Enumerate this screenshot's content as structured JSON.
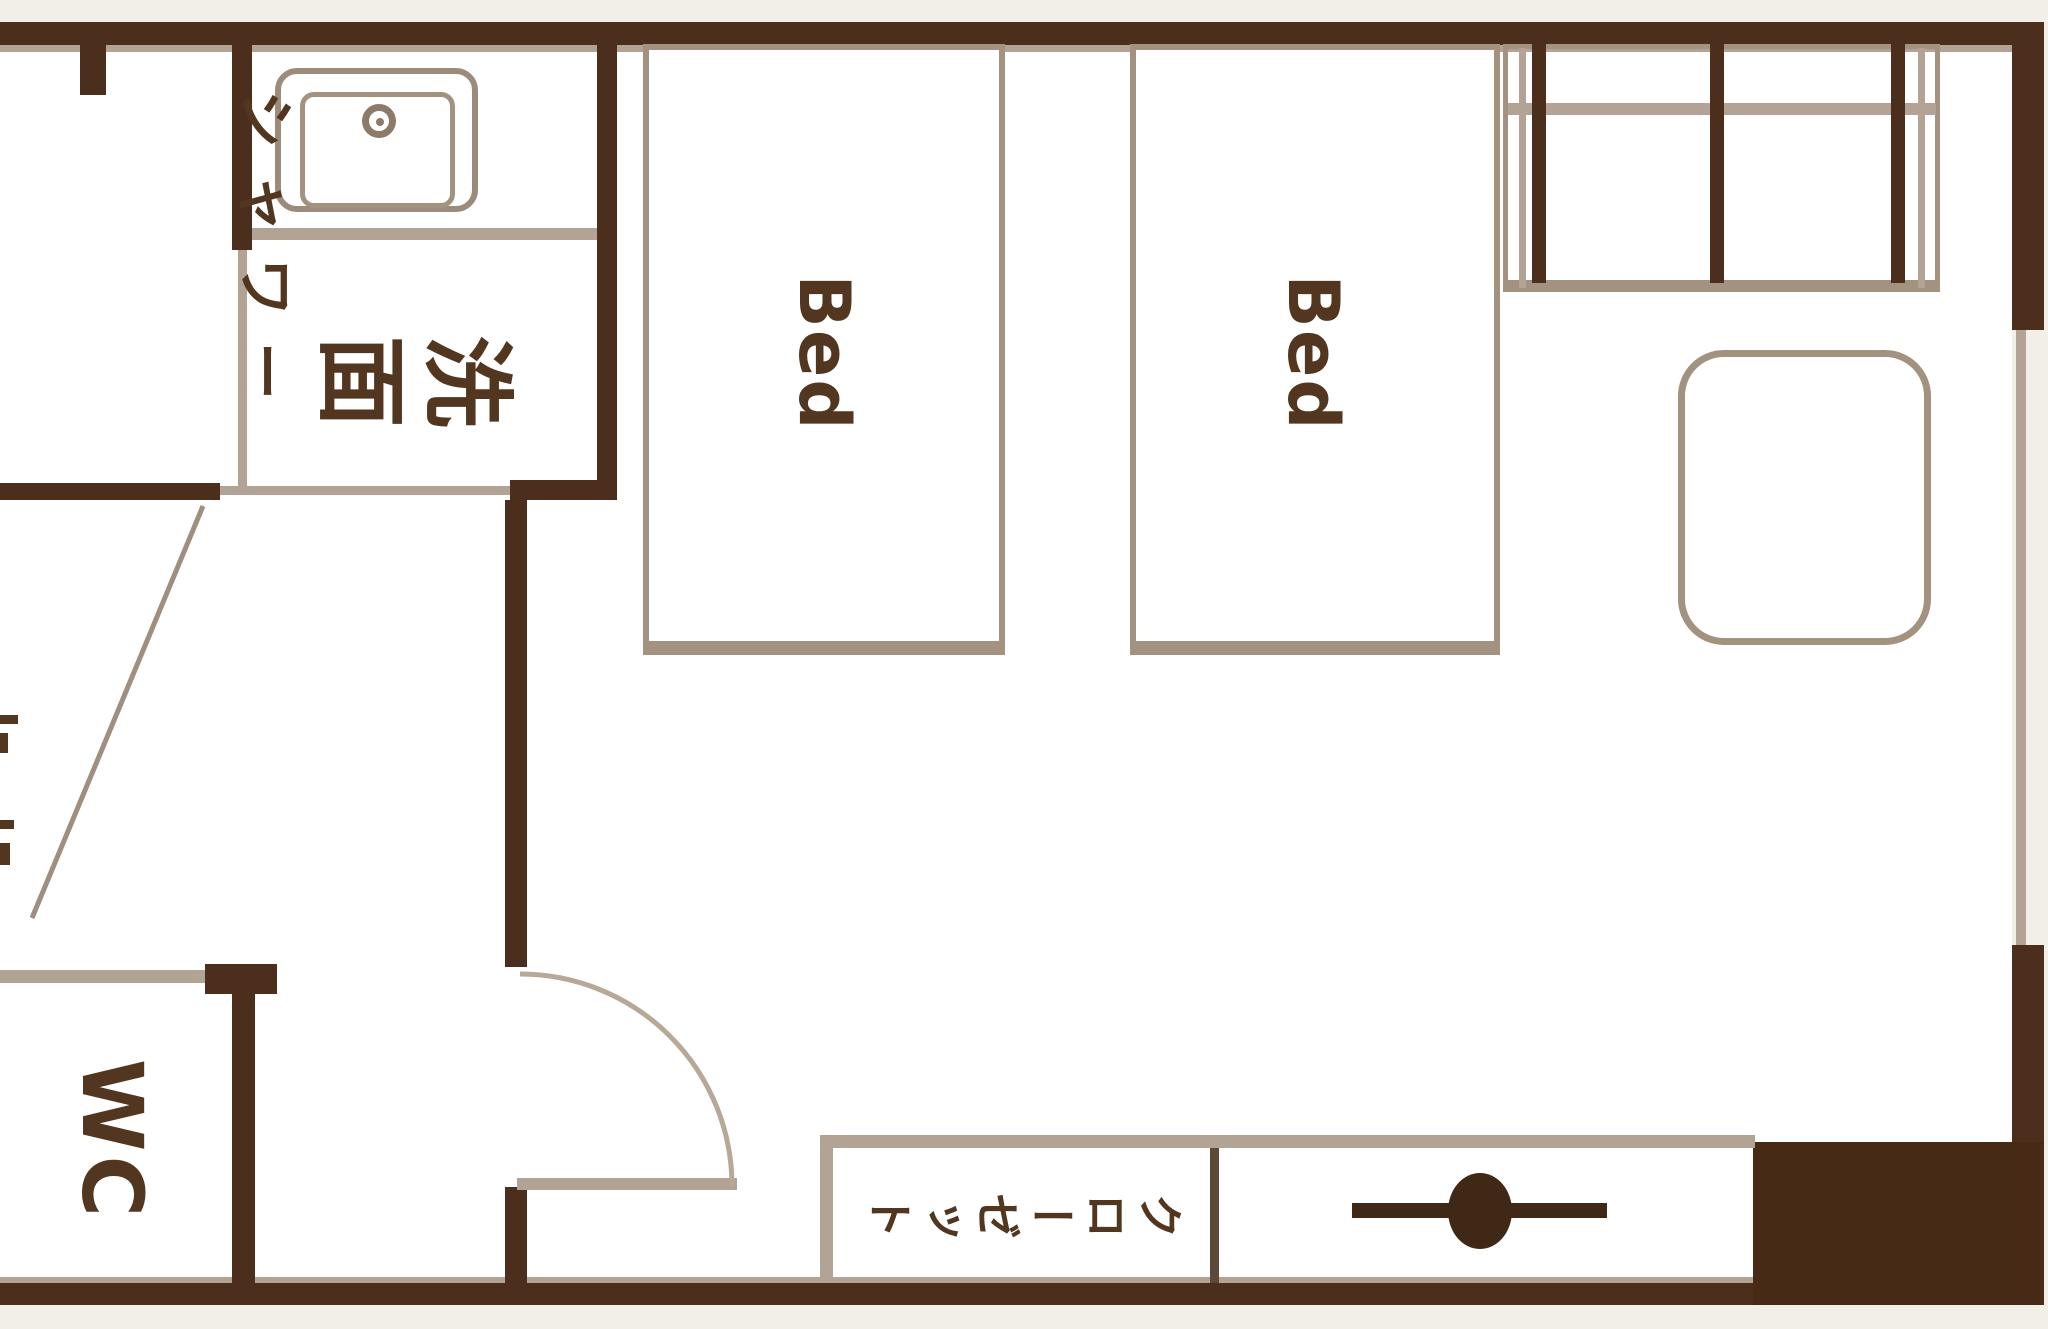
{
  "title": "hotel room floor plan",
  "colors": {
    "background": "#f1efe8",
    "floor": "#ffffff",
    "wall": "#4b2e1b",
    "pillar": "#472a16",
    "thin_wall_line": "#b2a395",
    "furniture_line": "#a3927f",
    "label_text": "#53361f",
    "hanger_symbol": "#402817"
  },
  "rooms": {
    "shower_room": {
      "label_line1": "シャワー",
      "label_line2": "ルーム"
    },
    "washroom": {
      "label": "洗面"
    },
    "wc": {
      "label": "WC"
    },
    "closet": {
      "label": "クローゼット"
    },
    "beds": {
      "bed1_label": "Bed",
      "bed2_label": "Bed"
    }
  },
  "symbols": {
    "sink": "sink-with-faucet",
    "door": "quarter-circle-swing-door",
    "closet_rod": "hanger-pipe-with-knob",
    "window": "thin-line-on-right-wall",
    "pillar": "solid-filled-wall-block"
  }
}
